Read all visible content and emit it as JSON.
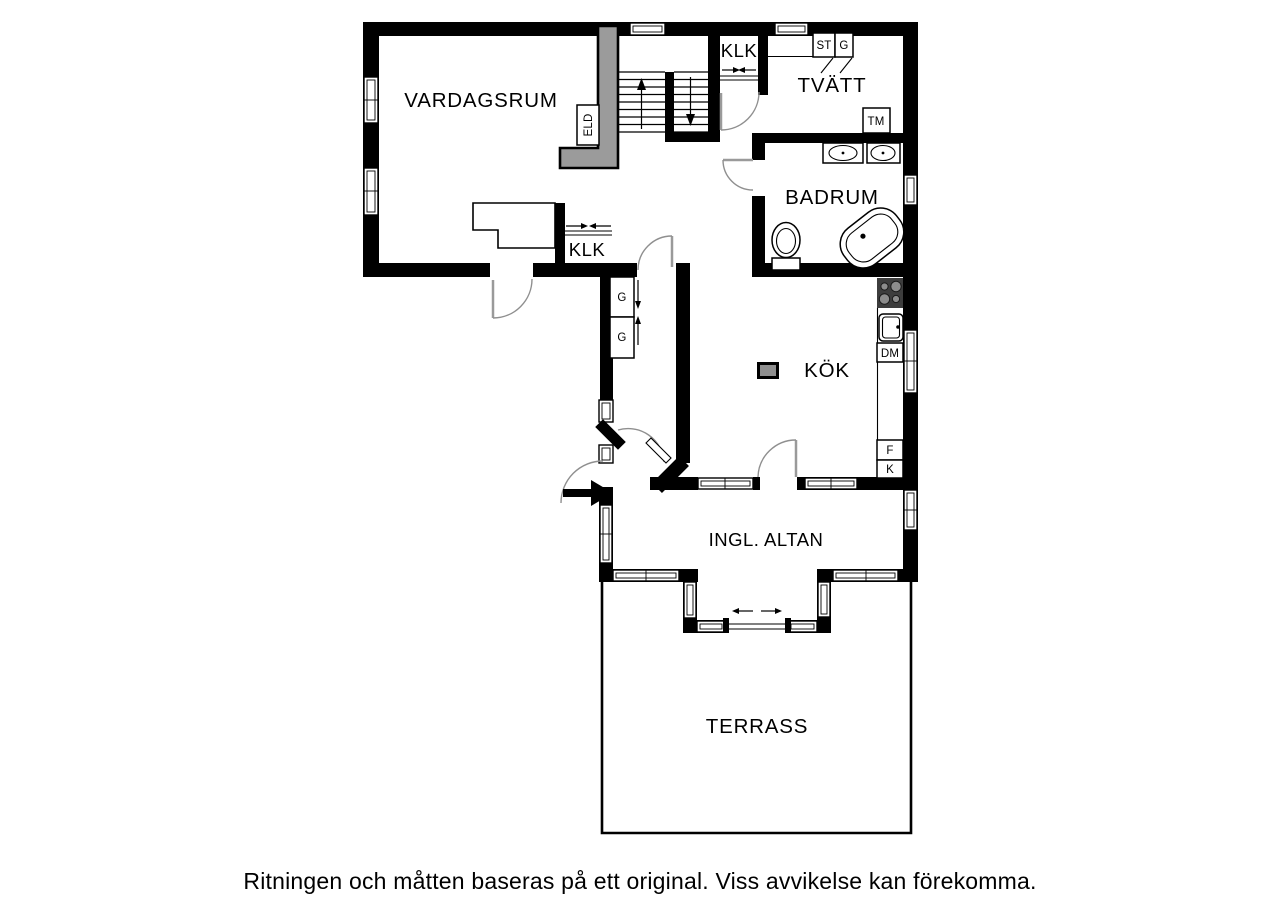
{
  "floorplan": {
    "rooms": {
      "vardagsrum": "VARDAGSRUM",
      "klk_upper": "KLK",
      "tvatt": "TVÄTT",
      "badrum": "BADRUM",
      "klk_lower": "KLK",
      "kok": "KÖK",
      "ingl_altan": "INGL. ALTAN",
      "terrass": "TERRASS"
    },
    "fixtures": {
      "eld": "ELD",
      "st": "ST",
      "g_tvatt": "G",
      "tm": "TM",
      "dm": "DM",
      "f": "F",
      "k": "K",
      "g_hall_1": "G",
      "g_hall_2": "G"
    },
    "disclaimer": "Ritningen och måtten baseras på ett original. Viss avvikelse kan förekomma.",
    "colors": {
      "wall": "#000000",
      "chimney": "#9b9b9b",
      "vent": "#8f8f8f",
      "stove": "#3d3d3d",
      "burner": "#8c8c8c",
      "door_arc": "#8f8f8f",
      "background": "#ffffff"
    }
  }
}
